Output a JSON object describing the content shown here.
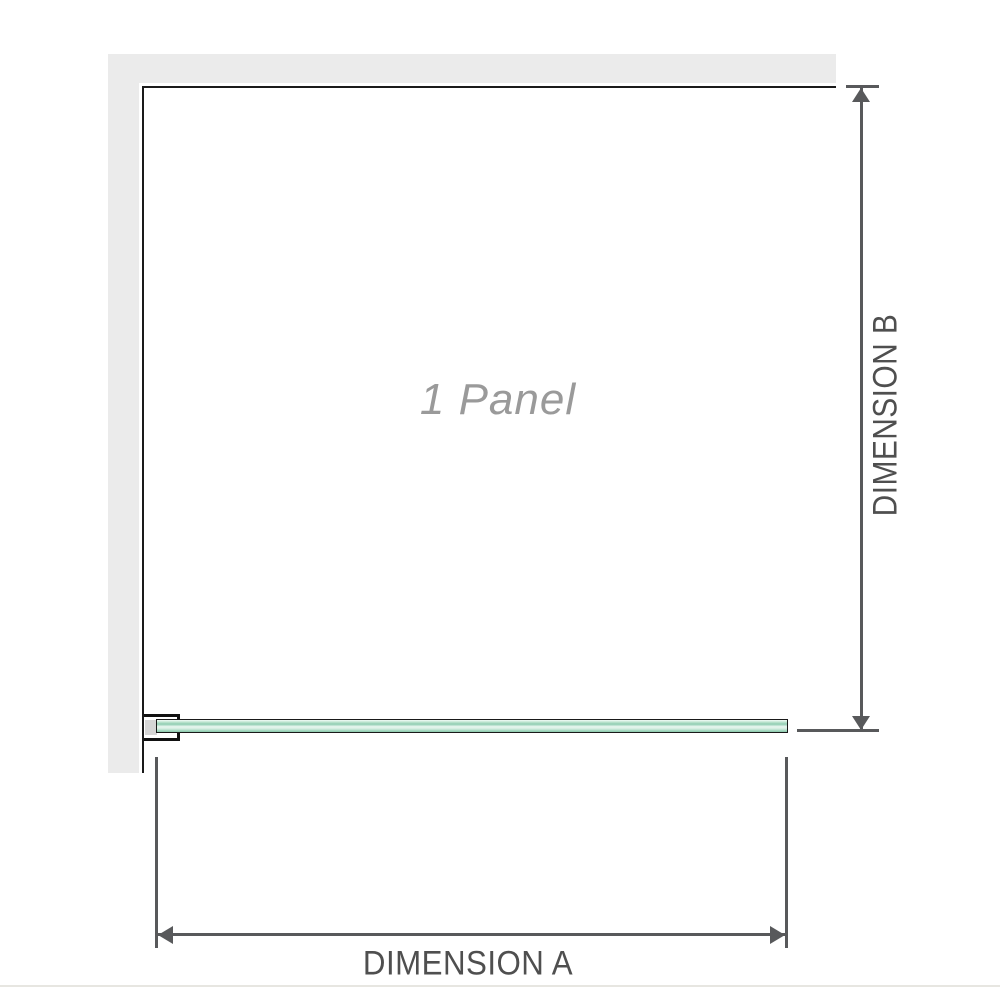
{
  "diagram": {
    "panel_label": "1 Panel",
    "dim_a_label": "DIMENSION A",
    "dim_b_label": "DIMENSION B"
  },
  "colors": {
    "background": "#ffffff",
    "wall_fill": "#ebebeb",
    "wall_edge_line": "#1a1a1a",
    "dimension_line": "#58595b",
    "dimension_text": "#4f4f4f",
    "panel_label_text": "#9a9a9a",
    "glass_green_dark": "#8cc7ab",
    "glass_green_light": "#e9f7f0",
    "bracket_fill": "#ffffff",
    "bracket_slot": "#d5d5d5",
    "bottom_border": "#e7e6e1"
  }
}
